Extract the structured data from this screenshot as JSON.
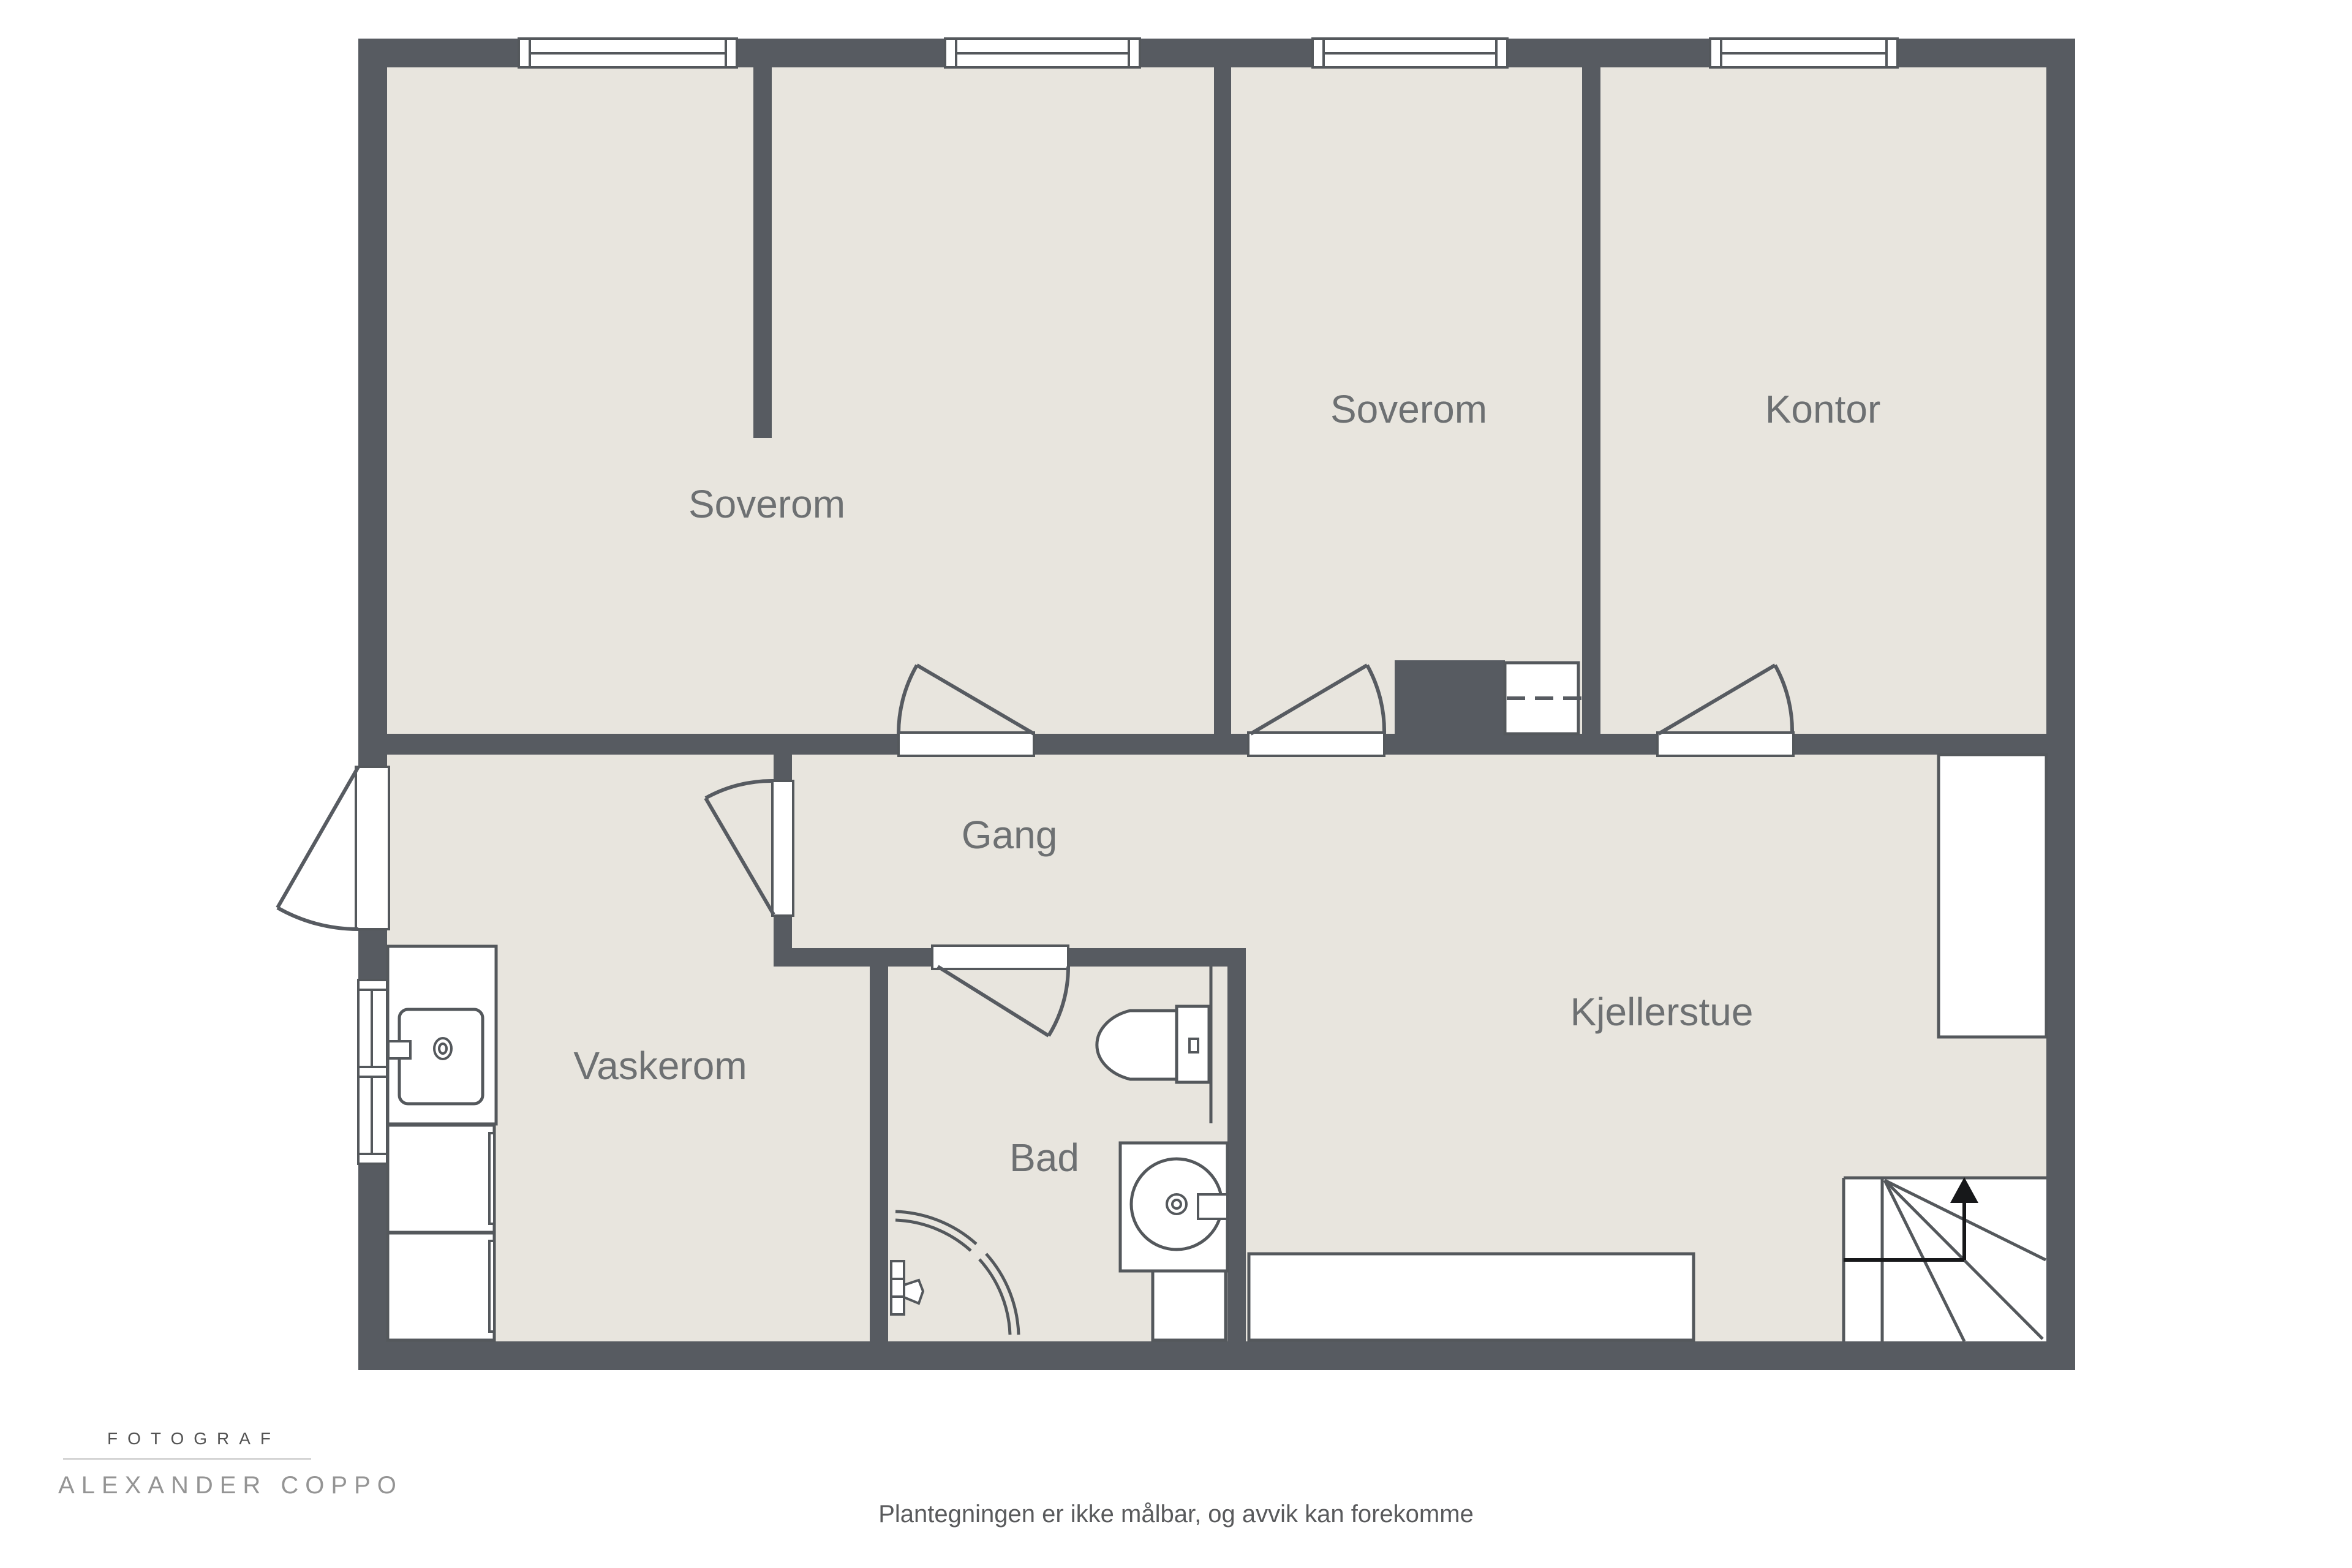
{
  "title": "Plantegning kjeller",
  "colors": {
    "background": "#ffffff",
    "wall": "#575b61",
    "floor": "#e8e5de",
    "fixture_fill": "#ffffff",
    "fixture_outline": "#54585c",
    "room_label": "#6d7072",
    "footer_text": "#595a5c",
    "watermark_dark": "#535353",
    "watermark_light": "#949494",
    "stairs_arrow": "#17181a"
  },
  "rooms": [
    {
      "id": "soverom-1",
      "label": "Soverom"
    },
    {
      "id": "soverom-2",
      "label": "Soverom"
    },
    {
      "id": "kontor",
      "label": "Kontor"
    },
    {
      "id": "gang",
      "label": "Gang"
    },
    {
      "id": "vaskerom",
      "label": "Vaskerom"
    },
    {
      "id": "bad",
      "label": "Bad"
    },
    {
      "id": "kjellerstue",
      "label": "Kjellerstue"
    }
  ],
  "fixtures": [
    {
      "icon": "window-icon",
      "count": 5
    },
    {
      "icon": "door-swing-icon",
      "count": 6
    },
    {
      "icon": "toilet-icon",
      "count": 1
    },
    {
      "icon": "washbasin-icon",
      "count": 2
    },
    {
      "icon": "shower-icon",
      "count": 1
    },
    {
      "icon": "appliance-icon",
      "count": 2
    },
    {
      "icon": "bench-icon",
      "count": 1
    },
    {
      "icon": "wardrobe-icon",
      "count": 1
    },
    {
      "icon": "stairs-icon",
      "count": 1
    },
    {
      "icon": "up-arrow-icon",
      "count": 1
    },
    {
      "icon": "chimney-icon",
      "count": 1
    },
    {
      "icon": "hatch-dashed-icon",
      "count": 1
    }
  ],
  "footer": {
    "disclaimer": "Plantegningen er ikke målbar, og avvik kan forekomme"
  },
  "watermark": {
    "profession": "FOTOGRAF",
    "name": "ALEXANDER COPPO"
  }
}
